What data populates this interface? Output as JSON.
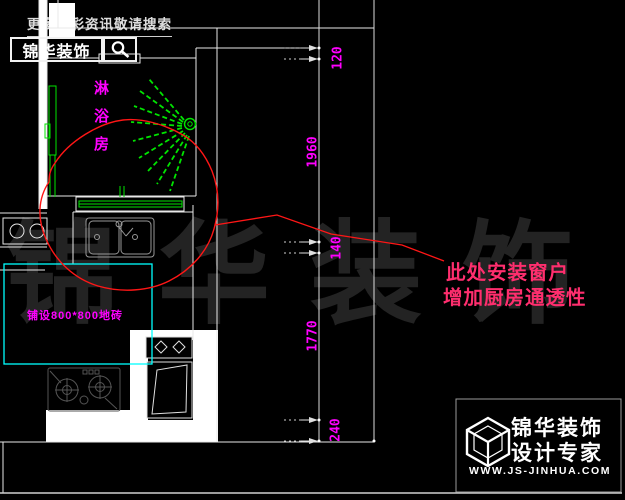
{
  "header": {
    "search_hint": "更多精彩资讯敬请搜索",
    "logo": "锦华装饰"
  },
  "plan": {
    "room_label": "淋浴房",
    "room_label_chars": [
      "淋",
      "浴",
      "房"
    ],
    "floor_note": "铺设800*800地砖",
    "dims": [
      "120",
      "1960",
      "140",
      "1770",
      "240"
    ],
    "note_line1": "此处安装窗户",
    "note_line2": "增加厨房通透性"
  },
  "watermark": {
    "text": "锦华装饰"
  },
  "footer": {
    "brand_line1": "锦华装饰",
    "brand_line2": "设计专家",
    "url": "WWW.JS-JINHUA.COM"
  },
  "colors": {
    "background": "#000000",
    "cad_white_lines": "#e8e8e8",
    "cad_green": "#00e400",
    "cad_magenta": "#ff00ff",
    "cad_cyan": "#00ffff",
    "annotation_text_red": "#ff2e6e",
    "annotation_line_red": "#ff1616",
    "watermark_gray": "#232323"
  }
}
